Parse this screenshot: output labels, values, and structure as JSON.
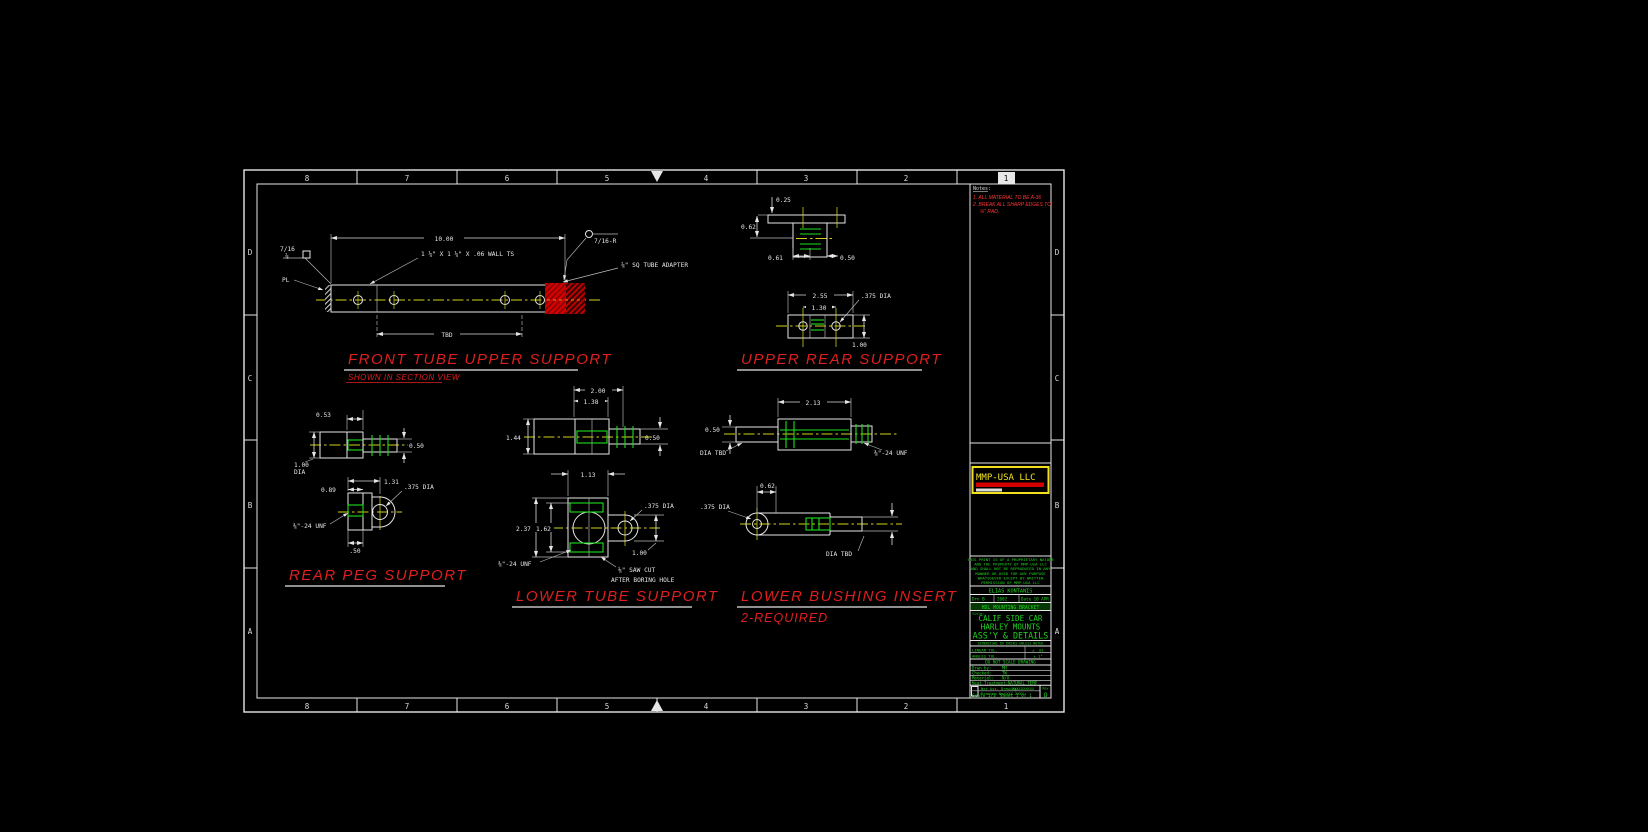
{
  "zones": {
    "numbers": [
      "8",
      "7",
      "6",
      "5",
      "4",
      "3",
      "2",
      "1"
    ],
    "letters": [
      "D",
      "C",
      "B",
      "A"
    ]
  },
  "notes": {
    "header": "Notes:",
    "line1": "1. ALL MATERIAL TO BE A-36",
    "line2": "2. BREAK ALL SHARP EDGES TO",
    "line3": "⅛\" RAD."
  },
  "views": {
    "front_tube_upper_support": {
      "title": "FRONT TUBE UPPER SUPPORT",
      "subtitle": "SHOWN IN SECTION VIEW",
      "dim_length": "10.00",
      "dim_tbd": "TBD",
      "tube_note": "1 ¼\" X 1 ¼\" X .06 WALL TS",
      "adapter_note": "⅞\" SQ TUBE ADAPTER",
      "plate_label": "PL",
      "weld_upper": "7/16",
      "weld_lower": "⅞",
      "weld_right": "7/16-R"
    },
    "upper_rear_support": {
      "title": "UPPER REAR SUPPORT",
      "dim_flange": "0.25",
      "dim_062": "0.62",
      "dim_061": "0.61",
      "dim_050": "0.50",
      "dim_width": "2.55",
      "dim_spacing": "1.30",
      "hole_note": ".375 DIA",
      "dim_height": "1.00"
    },
    "rear_peg_support": {
      "title": "REAR PEG SUPPORT",
      "dim_053": "0.53",
      "dim_050": "0.50",
      "dim_100": "1.00",
      "dim_dia": "DIA",
      "dim_089": "0.89",
      "dim_131": "1.31",
      "hole_note": ".375 DIA",
      "thread_note": "⅜\"-24 UNF",
      "dim_half": ".50"
    },
    "lower_tube_support": {
      "title": "LOWER TUBE SUPPORT",
      "dim_200": "2.00",
      "dim_138": "1.38",
      "dim_144": "1.44",
      "dim_050": "0.50",
      "dim_113": "1.13",
      "dim_237": "2.37",
      "dim_162": "1.62",
      "hole_note": ".375 DIA",
      "dim_100": "1.00",
      "thread_note": "⅜\"-24 UNF",
      "saw_note_1": "⅛\" SAW CUT",
      "saw_note_2": "AFTER BORING HOLE"
    },
    "lower_bushing_insert": {
      "title": "LOWER BUSHING INSERT",
      "subtitle": "2-REQUIRED",
      "dim_213": "2.13",
      "dim_050": "0.50",
      "dia_tbd_a": "DIA TBD",
      "thread_note": "⅜\"-24 UNF",
      "dim_062": "0.62",
      "hole_note": ".375 DIA",
      "dia_tbd_b": "DIA TBD"
    }
  },
  "title_block": {
    "logo": "MMP-USA LLC",
    "proprietary": [
      "THIS PRINT IS OF A PROPRIETARY NATURE",
      "AND THE PROPERTY OF MMP-USA LLC",
      "AND SHALL NOT BE REPRODUCED IN ANY",
      "MANNER OR USED FOR ANY PURPOSE",
      "WHATSOEVER EXCEPT BY WRITTEN",
      "PERMISSION OF MMP-USA LLC"
    ],
    "company": "ELIAS KONTANIS",
    "drn": "Drn B",
    "drn_date": "2002",
    "date": "Date 10 APR",
    "project": "HDL MOUNTING BRACKET",
    "title_label": "Title:",
    "title_line1": "CALIF SIDE CAR",
    "title_line2": "HARLEY MOUNTS",
    "title_line3": "ASS'Y & DETAILS",
    "dims_note": "DIMENSIONS IN INCHES UNLESS NOTED",
    "tol_linear_label": "LINEAR TOL.",
    "tol_linear": "± .01",
    "tol_angle_label": "ANGLES TOL.",
    "tol_angle": "± 1°",
    "no_scale": "DO NOT SCALE DRAWING",
    "drawn_label": "Drwn by:",
    "drawn": "MH",
    "checked_label": "Checked:",
    "checked": "TW",
    "material_label": "Material:",
    "material": "N/A",
    "heat_label": "Heat Treatment:",
    "heat": "NATURAL TEMP",
    "next_assy_label": "Nxt Ass. Drawing:",
    "next_assy": "XXXXXXXXXX",
    "drawing_no_label": "Drawing No.",
    "drawing_no": "XXXX-XXXX",
    "rev_label": "Rev",
    "rev": "O",
    "scale": "Scale 1/1",
    "sheet": "Sheet 1 of 1"
  },
  "colors": {
    "background": "#000000",
    "line_white": "#e6e6e6",
    "centerline_yellow": "#cfcf1a",
    "hidden_green": "#1ddf1d",
    "title_red": "#df1f1f",
    "note_red": "#ff3434",
    "adapter_red": "#d40000",
    "logo_yellow": "#f2e11c",
    "titleblock_green": "#1fd41f"
  }
}
